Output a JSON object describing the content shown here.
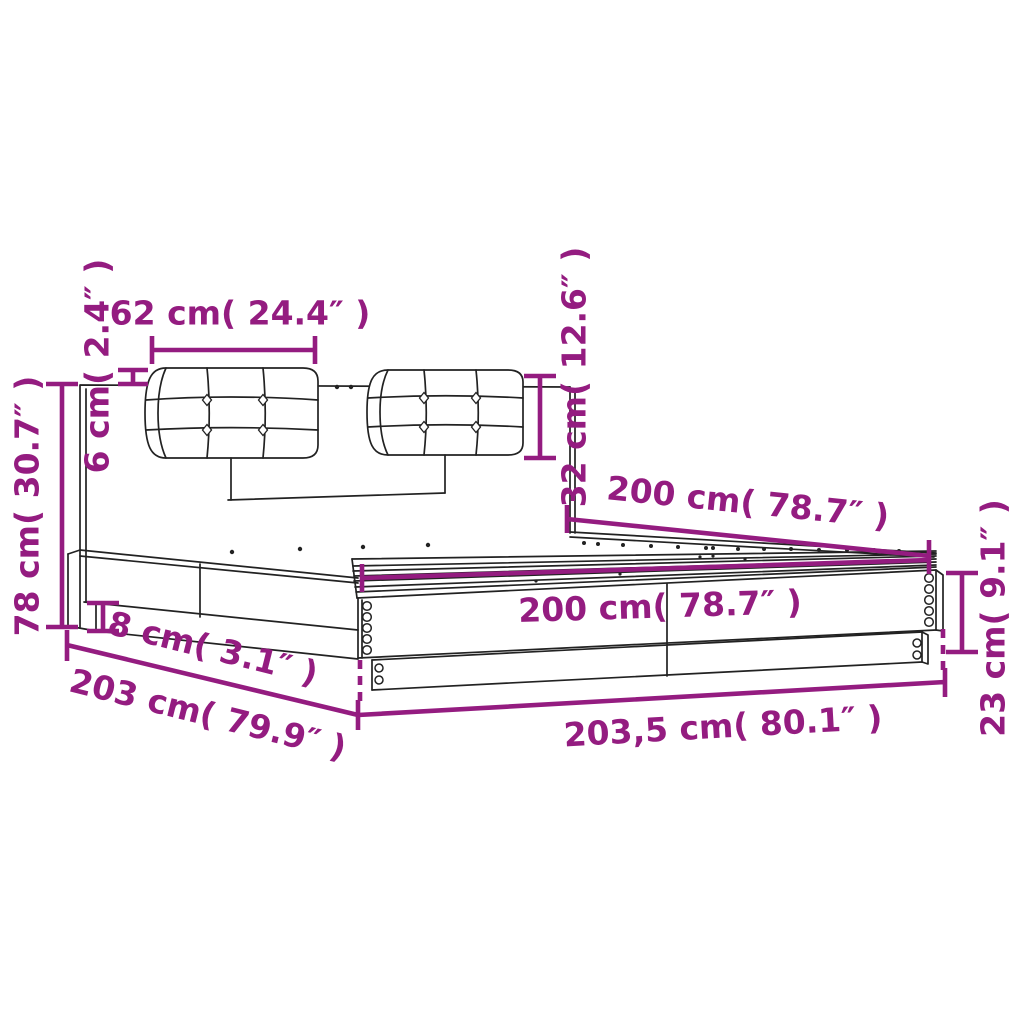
{
  "diagram": {
    "subject": "bed-frame-with-headboard-dimension-diagram",
    "colors": {
      "dimension_lines": "#941C80",
      "outline": "#222222",
      "background": "#FFFFFF"
    },
    "dimensions": [
      {
        "name": "cushion-width",
        "text": "62 cm( 24.4″ )"
      },
      {
        "name": "cushion-overhang",
        "text": "6 cm( 2.4″ )"
      },
      {
        "name": "headboard-height",
        "text": "78 cm( 30.7″ )"
      },
      {
        "name": "cushion-height",
        "text": "32 cm( 12.6″ )"
      },
      {
        "name": "bed-width-diagonal",
        "text": "200 cm( 78.7″ )"
      },
      {
        "name": "slat-area-length",
        "text": "200 cm( 78.7″ )"
      },
      {
        "name": "base-plinth-height",
        "text": "8 cm( 3.1″ )"
      },
      {
        "name": "total-width",
        "text": "203 cm( 79.9″ )"
      },
      {
        "name": "total-length",
        "text": "203,5 cm( 80.1″ )"
      },
      {
        "name": "side-rail-height",
        "text": "23 cm( 9.1″ )"
      }
    ]
  }
}
